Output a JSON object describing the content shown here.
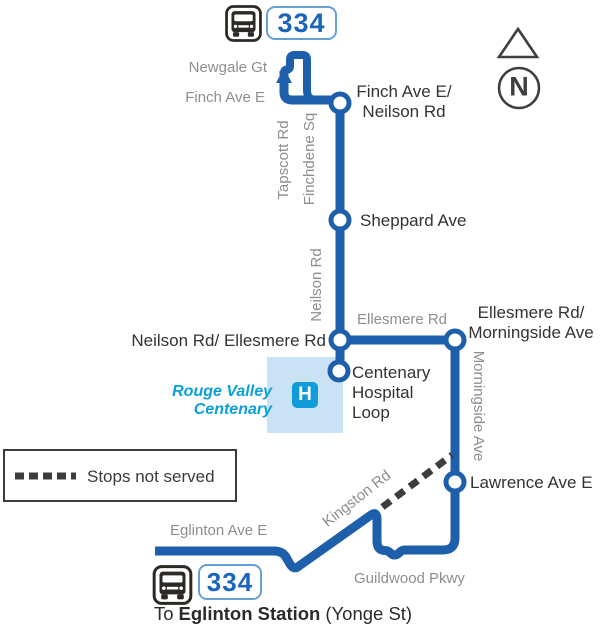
{
  "route": {
    "number": "334"
  },
  "stops": {
    "finch_neilson": {
      "line1": "Finch Ave E/",
      "line2": "Neilson Rd"
    },
    "sheppard": {
      "label": "Sheppard Ave"
    },
    "neilson_ellesmere": {
      "label": "Neilson Rd/ Ellesmere Rd"
    },
    "ellesmere_morningside": {
      "line1": "Ellesmere Rd/",
      "line2": "Morningside Ave"
    },
    "centenary_loop": {
      "line1": "Centenary",
      "line2": "Hospital",
      "line3": "Loop"
    },
    "lawrence": {
      "label": "Lawrence Ave E"
    }
  },
  "streets": {
    "newgale": "Newgale Gt",
    "finch": "Finch Ave E",
    "tapscott": "Tapscott Rd",
    "finchdene": "Finchdene Sq",
    "neilson": "Neilson Rd",
    "ellesmere": "Ellesmere Rd",
    "morningside": "Morningside Ave",
    "kingston": "Kingston Rd",
    "eglinton": "Eglinton Ave E",
    "guildwood": "Guildwood Pkwy"
  },
  "hospital": {
    "name_line1": "Rouge Valley",
    "name_line2": "Centenary",
    "icon_letter": "H"
  },
  "legend": {
    "stops_not_served": "Stops not served"
  },
  "compass": {
    "letter": "N"
  },
  "destination": {
    "prefix": "To",
    "station": "Eglinton Station",
    "suffix": "(Yonge St)"
  },
  "icons": {
    "bus": "bus-front-icon",
    "north_triangle": "triangle-up-icon",
    "compass": "letter-n-circle-icon",
    "hospital": "h-square-icon",
    "direction_arrow": "arrow-up-icon",
    "stops_not_served_style": "thick-dashed-line"
  },
  "colors": {
    "route-blue": "#1e5fab",
    "street-gray": "#8e8e90",
    "label-black": "#333333",
    "dash-gray": "#3d3d3d",
    "hospital-area-blue": "#c9e3f5",
    "hospital-icon-blue": "#0f9cd8",
    "hospital-text-blue": "#0aa0dc",
    "badge-border-blue": "#66a1d4",
    "badge-text-blue": "#1b65bb"
  }
}
